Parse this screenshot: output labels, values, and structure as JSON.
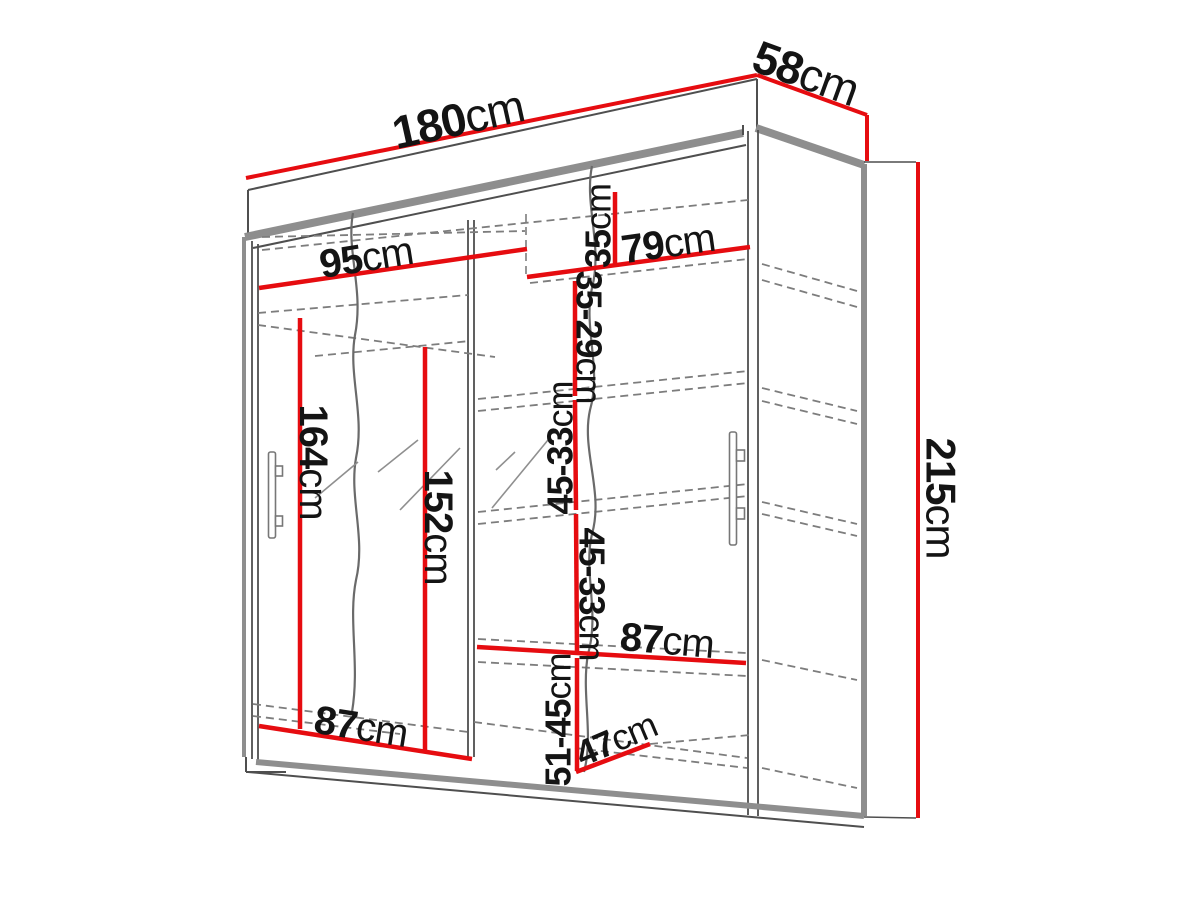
{
  "diagram": {
    "type": "wardrobe-dimension-drawing",
    "unit": "cm",
    "colors": {
      "dimension_line": "#e60c10",
      "outline_thick": "#8e8e8e",
      "outline_thin": "#4f4f4f",
      "dashed_line": "#7d7d7d",
      "label_text": "#141414",
      "background": "#ffffff"
    },
    "dimensions": {
      "total_width": {
        "num": "180",
        "unit": "cm"
      },
      "total_depth": {
        "num": "58",
        "unit": "cm"
      },
      "total_height": {
        "num": "215",
        "unit": "cm"
      },
      "top_shelf_left_width": {
        "num": "95",
        "unit": "cm"
      },
      "top_shelf_right_width": {
        "num": "79",
        "unit": "cm"
      },
      "top_section_height": {
        "num": "35",
        "unit": "cm"
      },
      "upper_right_section_height": {
        "num": "35-29",
        "unit": "cm"
      },
      "middle_right_section_height_upper": {
        "num": "45-33",
        "unit": "cm"
      },
      "middle_right_section_height_lower": {
        "num": "45-33",
        "unit": "cm"
      },
      "left_hanging_height": {
        "num": "164",
        "unit": "cm"
      },
      "mirror_door_height": {
        "num": "152",
        "unit": "cm"
      },
      "right_shelf_width": {
        "num": "87",
        "unit": "cm"
      },
      "bottom_left_shelf_width": {
        "num": "87",
        "unit": "cm"
      },
      "bottom_right_section_height": {
        "num": "51-45",
        "unit": "cm"
      },
      "bottom_shelf_depth": {
        "num": "47",
        "unit": "cm"
      }
    }
  }
}
